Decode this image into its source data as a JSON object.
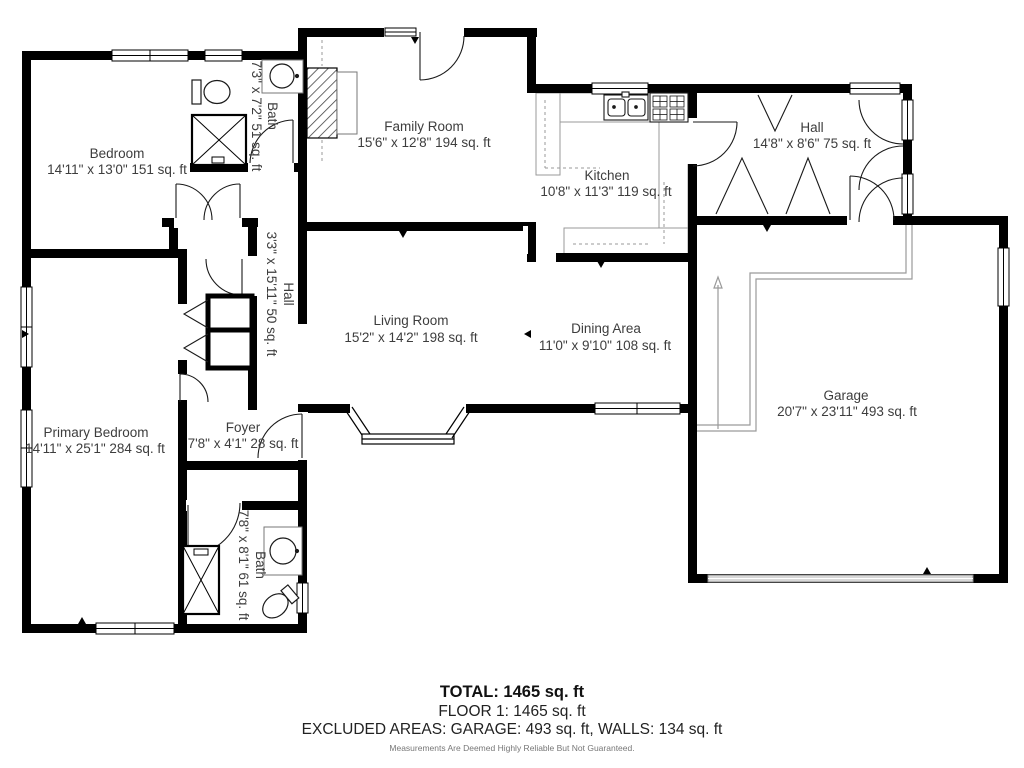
{
  "rooms": {
    "bedroom": {
      "name": "Bedroom",
      "dims": "14'11\" x 13'0\" 151 sq. ft"
    },
    "bath_top": {
      "name": "Bath",
      "dims": "7'3\" x 7'2\" 51 sq. ft"
    },
    "family_room": {
      "name": "Family Room",
      "dims": "15'6\" x 12'8\" 194 sq. ft"
    },
    "kitchen": {
      "name": "Kitchen",
      "dims": "10'8\" x 11'3\" 119 sq. ft"
    },
    "hall_top": {
      "name": "Hall",
      "dims": "14'8\" x 8'6\" 75 sq. ft"
    },
    "hall_mid": {
      "name": "Hall",
      "dims": "3'3\" x 15'11\" 50 sq. ft"
    },
    "living_room": {
      "name": "Living Room",
      "dims": "15'2\" x 14'2\" 198 sq. ft"
    },
    "dining_area": {
      "name": "Dining Area",
      "dims": "11'0\" x 9'10\" 108 sq. ft"
    },
    "garage": {
      "name": "Garage",
      "dims": "20'7\" x 23'11\" 493 sq. ft"
    },
    "primary_bedroom": {
      "name": "Primary Bedroom",
      "dims": "14'11\" x 25'1\" 284 sq. ft"
    },
    "foyer": {
      "name": "Foyer",
      "dims": "7'8\" x 4'1\" 28 sq. ft"
    },
    "bath_bottom": {
      "name": "Bath",
      "dims": "7'8\" x 8'1\" 61 sq. ft"
    }
  },
  "summary": {
    "total": "TOTAL: 1465 sq. ft",
    "floor": "FLOOR 1: 1465 sq. ft",
    "excluded": "EXCLUDED AREAS: GARAGE: 493 sq. ft, WALLS: 134 sq. ft",
    "disclaimer": "Measurements Are Deemed Highly Reliable But Not Guaranteed."
  },
  "colors": {
    "wall": "#000000",
    "text": "#3d3d3d",
    "counter": "#999999",
    "garage_door": "#d8d8d8"
  }
}
